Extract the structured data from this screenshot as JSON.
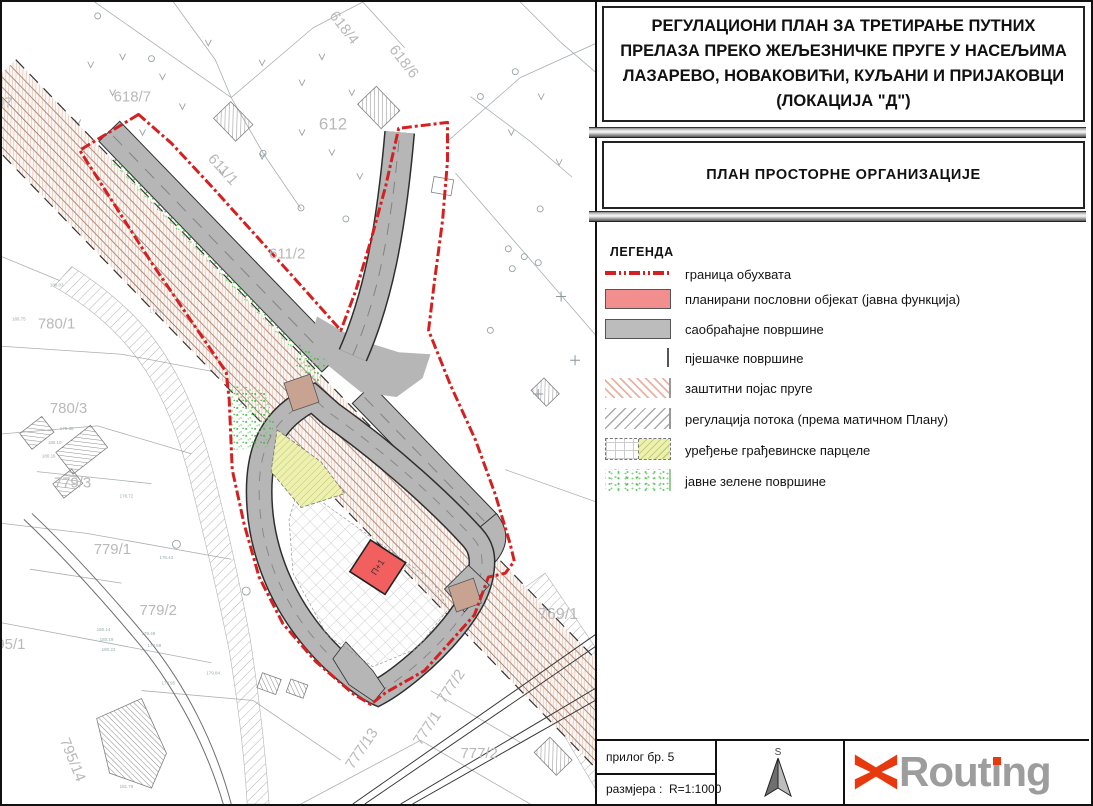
{
  "title": {
    "line1": "РЕГУЛАЦИОНИ ПЛАН ЗА ТРЕТИРАЊЕ ПУТНИХ",
    "line2": "ПРЕЛАЗА ПРЕКО ЖЕЉЕЗНИЧКЕ ПРУГЕ У НАСЕЉИМА",
    "line3": "ЛАЗАРЕВО, НОВАКОВИЋИ, КУЉАНИ И ПРИЈАКОВЦИ",
    "line4": "(ЛОКАЦИЈА \"Д\")"
  },
  "subtitle": "ПЛАН ПРОСТОРНЕ ОРГАНИЗАЦИЈЕ",
  "legend": {
    "heading": "ЛЕГЕНДА",
    "items": [
      {
        "symbol": "red-dash-dot-line",
        "label": "граница обухвата"
      },
      {
        "symbol": "pink-fill",
        "label": "планирани пословни објекат (јавна функција)"
      },
      {
        "symbol": "gray-fill",
        "label": "саобраћајне површине"
      },
      {
        "symbol": "thin-line",
        "label": "пјешачке површине"
      },
      {
        "symbol": "salmon-hatch",
        "label": "заштитни појас пруге"
      },
      {
        "symbol": "gray-hatch",
        "label": "регулација потока (према матичном Плану)"
      },
      {
        "symbol": "grid-and-yellow",
        "label": "уређење грађевинске парцеле"
      },
      {
        "symbol": "green-stipple",
        "label": "јавне зелене површине"
      }
    ]
  },
  "footer": {
    "attachment_label": "прилог бр. 5",
    "scale_label": "размјера :  R=1:1000",
    "north_letter": "S",
    "logo": {
      "part1": "Rout",
      "i_stem": "ı",
      "part2": "ng"
    }
  },
  "map": {
    "building_label": "П+1",
    "parcels": [
      {
        "label": "618/7"
      },
      {
        "label": "618/4"
      },
      {
        "label": "618/6"
      },
      {
        "label": "612"
      },
      {
        "label": "611/1"
      },
      {
        "label": "611/2"
      },
      {
        "label": "780/1"
      },
      {
        "label": "780/3"
      },
      {
        "label": "779/3"
      },
      {
        "label": "779/1"
      },
      {
        "label": "779/2"
      },
      {
        "label": "795/1"
      },
      {
        "label": "795/14"
      },
      {
        "label": "777/13"
      },
      {
        "label": "777/1"
      },
      {
        "label": "777/2"
      },
      {
        "label": "777/2"
      },
      {
        "label": "769/1"
      },
      {
        "label": "07"
      }
    ],
    "spot_elevations": [
      "180.03",
      "180.75",
      "178.92",
      "179.38",
      "180.10",
      "180.16",
      "178.72",
      "176.43",
      "179.49",
      "179.58",
      "179.95",
      "180.14",
      "180.19",
      "180.22",
      "179.84",
      "181.70"
    ]
  },
  "colors": {
    "boundary_red": "#d42020",
    "object_pink": "#f28e8e",
    "road_gray": "#b6b6b6",
    "rail_salmon": "#dcae9e",
    "parcel_yellow": "#eef0b0",
    "public_green": "#3cbb3c",
    "logo_orange": "#e8380d",
    "logo_gray": "#9d9d9d"
  }
}
